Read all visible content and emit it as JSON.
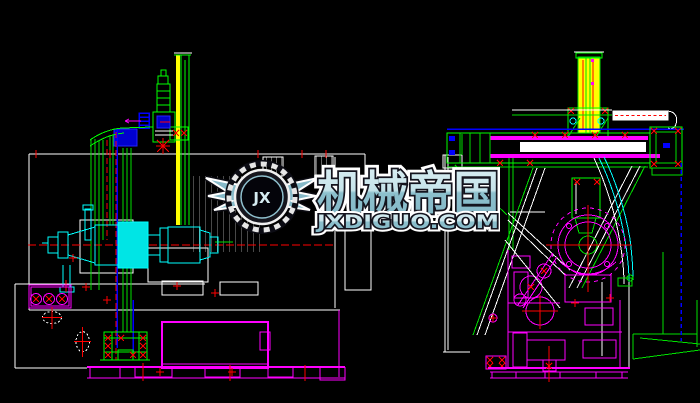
{
  "watermark": {
    "brand_cn": "机械帝国",
    "brand_domain": "JXDIGUO.COM",
    "logo_monogram": "JX",
    "colors": {
      "text_fill_light": "#d8edf2",
      "text_fill_teal": "#84b7c6",
      "outline_outer": "#ffffff",
      "outline_inner": "#14141e"
    }
  },
  "drawing": {
    "background": "#000000",
    "palette": {
      "outline_white": "#ffffff",
      "part_green": "#00e000",
      "part_cyan": "#00ffff",
      "part_magenta": "#ff00ff",
      "column_yellow": "#ffff00",
      "guide_blue": "#0000ff",
      "centerline_red": "#ff0000"
    }
  }
}
